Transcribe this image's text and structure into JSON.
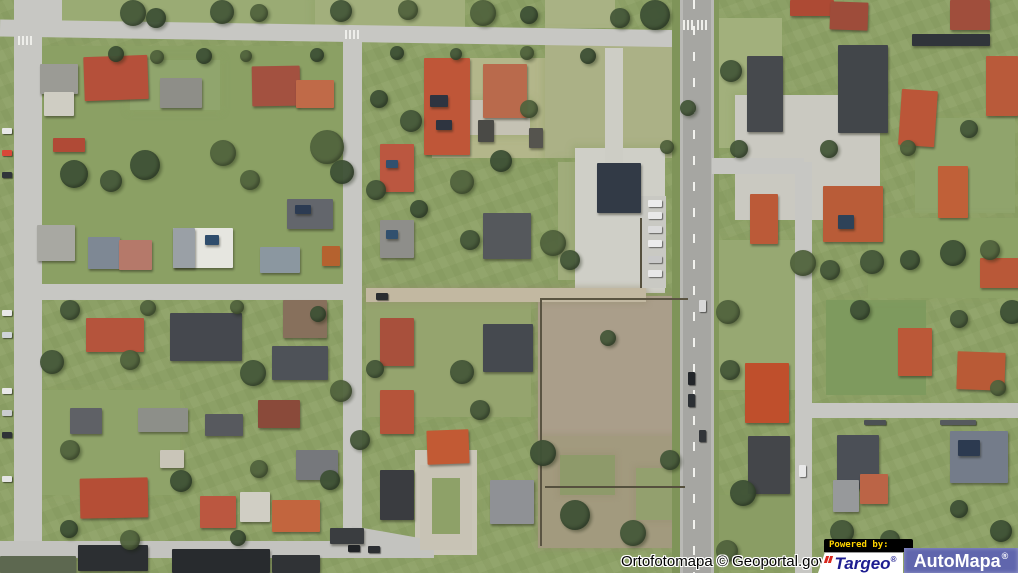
{
  "attribution": {
    "text": "Ortofotomapa © Geoportal.gov.pl"
  },
  "logos": {
    "powered_by": "Powered by:",
    "targeo": {
      "name": "Targeo",
      "registered": "®"
    },
    "automapa": {
      "name": "AutoMapa",
      "registered": "®"
    }
  },
  "colors": {
    "grass_base": "#8ca066",
    "road_gray": "#c7c7c3",
    "highway_asphalt": "#a6a6a2",
    "dirt_lot": "#aa9e8a",
    "roof_red": "#b5503a",
    "roof_dark": "#45484e",
    "targeo_navy": "#1d1d90",
    "targeo_red": "#d8251c",
    "automapa_blue": "#6066ad",
    "powered_yellow": "#ffd400",
    "attribution_text": "#000000",
    "attribution_halo": "#ffffff"
  },
  "map": {
    "fields": [
      [
        55,
        0,
        260,
        26,
        "#9aab74"
      ],
      [
        315,
        0,
        150,
        28,
        "#a2af7c"
      ],
      [
        545,
        0,
        70,
        28,
        "#a9b284"
      ],
      [
        432,
        58,
        118,
        100,
        "#b3b68a"
      ],
      [
        545,
        34,
        138,
        124,
        "#abb186"
      ],
      [
        558,
        162,
        96,
        118,
        "#a0ac7b"
      ],
      [
        366,
        302,
        165,
        115,
        "#95a46e"
      ],
      [
        28,
        46,
        330,
        238,
        "#8ba064"
      ],
      [
        30,
        390,
        150,
        105,
        "#8fa369"
      ],
      [
        712,
        18,
        70,
        130,
        "#a2b07c"
      ],
      [
        712,
        240,
        96,
        150,
        "#97a872"
      ],
      [
        915,
        118,
        100,
        95,
        "#90a46c"
      ],
      [
        826,
        300,
        100,
        95,
        "#7e9a5e"
      ],
      [
        712,
        495,
        100,
        75,
        "#8a9d64"
      ],
      [
        868,
        218,
        150,
        80,
        "#8da266"
      ],
      [
        575,
        148,
        90,
        145,
        "#cfcfc7"
      ],
      [
        735,
        95,
        145,
        125,
        "#cac9c1"
      ],
      [
        415,
        450,
        62,
        105,
        "#cac6b8"
      ],
      [
        455,
        100,
        75,
        35,
        "#c5c2b4"
      ],
      [
        130,
        60,
        90,
        50,
        "#90a56d"
      ]
    ],
    "lots": [
      [
        538,
        296,
        150,
        140,
        "#aa9e8a"
      ],
      [
        538,
        436,
        150,
        112,
        "#a29a7e"
      ],
      [
        560,
        455,
        55,
        40,
        "#8e9a6a"
      ],
      [
        636,
        468,
        48,
        52,
        "#93a06e"
      ],
      [
        366,
        288,
        280,
        14,
        "#c2b8a1"
      ]
    ],
    "roads": [
      [
        0,
        25,
        702,
        17,
        "#c7c7c3",
        0.9
      ],
      [
        40,
        0,
        22,
        28,
        "#c7c7c3"
      ],
      [
        14,
        0,
        28,
        573,
        "#c7c7c3"
      ],
      [
        343,
        38,
        19,
        507,
        "#c7c7c3"
      ],
      [
        28,
        284,
        320,
        16,
        "#c7c7c3"
      ],
      [
        0,
        541,
        434,
        17,
        "#c3c3bf"
      ],
      [
        350,
        532,
        70,
        16,
        "#c3c3bf",
        10
      ],
      [
        672,
        0,
        8,
        573,
        "#7f9459"
      ],
      [
        714,
        0,
        5,
        573,
        "#83985c"
      ],
      [
        680,
        0,
        34,
        573,
        "#a6a6a2"
      ],
      [
        680,
        0,
        3,
        573,
        "#b9b9b5"
      ],
      [
        711,
        0,
        3,
        573,
        "#b9b9b5"
      ],
      [
        712,
        158,
        92,
        16,
        "#c7c7c3"
      ],
      [
        795,
        162,
        17,
        411,
        "#c7c7c3"
      ],
      [
        803,
        403,
        215,
        15,
        "#c7c7c3"
      ],
      [
        640,
        196,
        26,
        92,
        "#c9c9c3"
      ],
      [
        605,
        48,
        18,
        118,
        "#cdcdc5"
      ],
      [
        420,
        465,
        52,
        85,
        "#c8c3b5"
      ],
      [
        432,
        478,
        28,
        56,
        "#8ea168"
      ]
    ],
    "lines": [
      [
        693,
        0,
        2,
        573,
        "dash"
      ],
      [
        540,
        298,
        148,
        2,
        "#5a5442"
      ],
      [
        540,
        298,
        2,
        248,
        "#5a5442"
      ],
      [
        545,
        486,
        140,
        2,
        "#55503e"
      ],
      [
        640,
        218,
        2,
        70,
        "#55503e"
      ],
      [
        18,
        36,
        2,
        9,
        "#eeeeea"
      ],
      [
        22,
        36,
        2,
        9,
        "#eeeeea"
      ],
      [
        26,
        36,
        2,
        9,
        "#eeeeea"
      ],
      [
        30,
        36,
        2,
        9,
        "#eeeeea"
      ],
      [
        345,
        30,
        2,
        9,
        "#eeeeea"
      ],
      [
        349,
        30,
        2,
        9,
        "#eeeeea"
      ],
      [
        353,
        30,
        2,
        9,
        "#eeeeea"
      ],
      [
        357,
        30,
        2,
        9,
        "#eeeeea"
      ],
      [
        683,
        20,
        2,
        10,
        "#eeeeea"
      ],
      [
        687,
        20,
        2,
        10,
        "#eeeeea"
      ],
      [
        691,
        20,
        2,
        10,
        "#eeeeea"
      ],
      [
        697,
        20,
        2,
        10,
        "#eeeeea"
      ],
      [
        701,
        20,
        2,
        10,
        "#eeeeea"
      ],
      [
        705,
        20,
        2,
        10,
        "#eeeeea"
      ]
    ],
    "houses": [
      [
        40,
        64,
        38,
        30,
        "#9b9b95"
      ],
      [
        44,
        92,
        30,
        24,
        "#cfcdc3"
      ],
      [
        84,
        56,
        64,
        44,
        "#b5503a",
        -2
      ],
      [
        160,
        78,
        42,
        30,
        "#8e8e88"
      ],
      [
        252,
        66,
        48,
        40,
        "#a35140",
        -1
      ],
      [
        296,
        80,
        38,
        28,
        "#c06a48"
      ],
      [
        53,
        138,
        32,
        14,
        "#b04a36"
      ],
      [
        424,
        58,
        46,
        97,
        "#bf5638"
      ],
      [
        430,
        95,
        18,
        12,
        "#2e3440"
      ],
      [
        436,
        120,
        16,
        10,
        "#2e3440"
      ],
      [
        483,
        64,
        44,
        54,
        "#b96a4c"
      ],
      [
        380,
        144,
        34,
        48,
        "#bb5740"
      ],
      [
        386,
        160,
        12,
        8,
        "#31506e"
      ],
      [
        478,
        120,
        16,
        22,
        "#4a4a46"
      ],
      [
        529,
        128,
        14,
        20,
        "#55544e"
      ],
      [
        597,
        163,
        44,
        50,
        "#323a46"
      ],
      [
        37,
        225,
        38,
        36,
        "#a8a8a2"
      ],
      [
        88,
        237,
        32,
        32,
        "#7e8894"
      ],
      [
        119,
        240,
        33,
        30,
        "#b5796a"
      ],
      [
        173,
        228,
        60,
        40,
        "#e6e6e0"
      ],
      [
        173,
        228,
        22,
        40,
        "#9aa0a6"
      ],
      [
        205,
        235,
        14,
        10,
        "#2f4d6c"
      ],
      [
        260,
        247,
        40,
        26,
        "#8b97a0"
      ],
      [
        287,
        199,
        46,
        30,
        "#63666c"
      ],
      [
        295,
        205,
        16,
        9,
        "#2c3b52"
      ],
      [
        322,
        246,
        18,
        20,
        "#b5622f"
      ],
      [
        380,
        220,
        34,
        38,
        "#8e8e8a"
      ],
      [
        386,
        230,
        12,
        9,
        "#31506e"
      ],
      [
        483,
        213,
        48,
        46,
        "#55585c"
      ],
      [
        86,
        318,
        58,
        34,
        "#b5543c"
      ],
      [
        170,
        313,
        72,
        48,
        "#45484e"
      ],
      [
        283,
        300,
        44,
        38,
        "#87705c"
      ],
      [
        272,
        346,
        56,
        34,
        "#4e5258"
      ],
      [
        380,
        318,
        34,
        48,
        "#a8503c"
      ],
      [
        483,
        324,
        50,
        48,
        "#45494f"
      ],
      [
        380,
        390,
        34,
        44,
        "#b5543a"
      ],
      [
        427,
        430,
        42,
        34,
        "#c25a34",
        -2
      ],
      [
        380,
        470,
        34,
        50,
        "#3a3c40"
      ],
      [
        490,
        480,
        44,
        44,
        "#8f9195"
      ],
      [
        138,
        408,
        50,
        24,
        "#8d8f89"
      ],
      [
        70,
        408,
        32,
        26,
        "#5f6166"
      ],
      [
        205,
        414,
        38,
        22,
        "#57595e"
      ],
      [
        258,
        400,
        42,
        28,
        "#8a4a3a"
      ],
      [
        296,
        450,
        42,
        30,
        "#76787c"
      ],
      [
        80,
        478,
        68,
        40,
        "#b54e36",
        -1
      ],
      [
        200,
        496,
        36,
        32,
        "#bb5740"
      ],
      [
        240,
        492,
        30,
        30,
        "#d0cec4"
      ],
      [
        272,
        500,
        48,
        32,
        "#c2653e"
      ],
      [
        160,
        450,
        24,
        18,
        "#c9c5b8"
      ],
      [
        78,
        545,
        70,
        26,
        "#2c2f32"
      ],
      [
        172,
        549,
        98,
        24,
        "#282b2e"
      ],
      [
        272,
        555,
        48,
        18,
        "#303336"
      ],
      [
        330,
        528,
        34,
        16,
        "#3a3d40"
      ],
      [
        0,
        556,
        76,
        17,
        "#5d6850"
      ],
      [
        790,
        0,
        44,
        16,
        "#ad4a34"
      ],
      [
        830,
        2,
        38,
        28,
        "#9e4c3a",
        2
      ],
      [
        950,
        0,
        40,
        30,
        "#a04e3c"
      ],
      [
        747,
        56,
        36,
        76,
        "#46494d"
      ],
      [
        838,
        45,
        50,
        88,
        "#42464a"
      ],
      [
        900,
        90,
        36,
        56,
        "#bb5638",
        4
      ],
      [
        986,
        56,
        32,
        60,
        "#b95a3a"
      ],
      [
        912,
        34,
        78,
        12,
        "#30343a"
      ],
      [
        750,
        194,
        28,
        50,
        "#bb5a38"
      ],
      [
        823,
        186,
        60,
        56,
        "#b95c38"
      ],
      [
        838,
        215,
        16,
        14,
        "#2e4258"
      ],
      [
        938,
        166,
        30,
        52,
        "#c06038"
      ],
      [
        980,
        258,
        40,
        30,
        "#b95838"
      ],
      [
        898,
        328,
        34,
        48,
        "#bb5838"
      ],
      [
        957,
        352,
        48,
        38,
        "#b95a36",
        2
      ],
      [
        745,
        363,
        44,
        60,
        "#bf4f2c"
      ],
      [
        748,
        436,
        42,
        58,
        "#44464a"
      ],
      [
        837,
        435,
        42,
        54,
        "#4b4f56"
      ],
      [
        950,
        431,
        58,
        52,
        "#747c8a"
      ],
      [
        958,
        440,
        22,
        16,
        "#2c3a50"
      ],
      [
        833,
        480,
        26,
        32,
        "#97999b"
      ],
      [
        860,
        474,
        28,
        30,
        "#bb6446"
      ]
    ],
    "trees": [
      [
        120,
        0,
        26
      ],
      [
        146,
        8,
        20
      ],
      [
        210,
        0,
        24
      ],
      [
        250,
        4,
        18
      ],
      [
        330,
        0,
        22
      ],
      [
        398,
        0,
        20
      ],
      [
        470,
        0,
        26
      ],
      [
        520,
        6,
        18
      ],
      [
        640,
        0,
        30
      ],
      [
        610,
        8,
        20
      ],
      [
        108,
        46,
        16
      ],
      [
        150,
        50,
        14
      ],
      [
        196,
        48,
        16
      ],
      [
        240,
        50,
        12
      ],
      [
        310,
        48,
        14
      ],
      [
        390,
        46,
        14
      ],
      [
        450,
        48,
        12
      ],
      [
        520,
        46,
        14
      ],
      [
        580,
        48,
        16
      ],
      [
        60,
        160,
        28
      ],
      [
        100,
        170,
        22
      ],
      [
        130,
        150,
        30
      ],
      [
        210,
        140,
        26
      ],
      [
        240,
        170,
        20
      ],
      [
        310,
        130,
        34
      ],
      [
        330,
        160,
        24
      ],
      [
        370,
        90,
        18
      ],
      [
        400,
        110,
        22
      ],
      [
        366,
        180,
        20
      ],
      [
        410,
        200,
        18
      ],
      [
        450,
        170,
        24
      ],
      [
        460,
        230,
        20
      ],
      [
        540,
        230,
        26
      ],
      [
        560,
        250,
        20
      ],
      [
        490,
        150,
        22
      ],
      [
        520,
        100,
        18
      ],
      [
        60,
        300,
        20
      ],
      [
        140,
        300,
        16
      ],
      [
        230,
        300,
        14
      ],
      [
        310,
        306,
        16
      ],
      [
        40,
        350,
        24
      ],
      [
        60,
        440,
        20
      ],
      [
        120,
        350,
        20
      ],
      [
        240,
        360,
        26
      ],
      [
        330,
        380,
        22
      ],
      [
        350,
        430,
        20
      ],
      [
        366,
        360,
        18
      ],
      [
        450,
        360,
        24
      ],
      [
        470,
        400,
        20
      ],
      [
        530,
        440,
        26
      ],
      [
        560,
        500,
        30
      ],
      [
        620,
        520,
        26
      ],
      [
        660,
        450,
        20
      ],
      [
        600,
        330,
        16
      ],
      [
        170,
        470,
        22
      ],
      [
        250,
        460,
        18
      ],
      [
        320,
        470,
        20
      ],
      [
        230,
        530,
        16
      ],
      [
        120,
        530,
        20
      ],
      [
        60,
        520,
        18
      ],
      [
        720,
        60,
        22
      ],
      [
        730,
        140,
        18
      ],
      [
        716,
        300,
        24
      ],
      [
        720,
        360,
        20
      ],
      [
        730,
        480,
        26
      ],
      [
        716,
        540,
        22
      ],
      [
        790,
        250,
        26
      ],
      [
        820,
        260,
        20
      ],
      [
        860,
        250,
        24
      ],
      [
        900,
        250,
        20
      ],
      [
        940,
        240,
        26
      ],
      [
        980,
        240,
        20
      ],
      [
        1000,
        300,
        24
      ],
      [
        820,
        140,
        18
      ],
      [
        900,
        140,
        16
      ],
      [
        960,
        120,
        18
      ],
      [
        850,
        300,
        20
      ],
      [
        950,
        310,
        18
      ],
      [
        990,
        380,
        16
      ],
      [
        830,
        520,
        24
      ],
      [
        880,
        530,
        20
      ],
      [
        950,
        500,
        18
      ],
      [
        990,
        520,
        22
      ],
      [
        680,
        100,
        16
      ],
      [
        660,
        140,
        14
      ]
    ],
    "cars": [
      [
        2,
        128,
        10,
        6,
        "#e8e8e8"
      ],
      [
        2,
        150,
        10,
        6,
        "#d84838"
      ],
      [
        2,
        172,
        10,
        6,
        "#30343a"
      ],
      [
        2,
        310,
        10,
        6,
        "#e8e8e8"
      ],
      [
        2,
        332,
        10,
        6,
        "#cfd4d8"
      ],
      [
        2,
        388,
        10,
        6,
        "#e8e8e8"
      ],
      [
        2,
        410,
        10,
        6,
        "#caccce"
      ],
      [
        2,
        432,
        10,
        6,
        "#2e3236"
      ],
      [
        2,
        476,
        10,
        6,
        "#e4e4e4"
      ],
      [
        648,
        200,
        14,
        7,
        "#ececec"
      ],
      [
        648,
        212,
        14,
        7,
        "#e8e8e8"
      ],
      [
        648,
        226,
        14,
        7,
        "#dadada"
      ],
      [
        648,
        240,
        14,
        7,
        "#ececec"
      ],
      [
        648,
        256,
        14,
        7,
        "#c8c8c8"
      ],
      [
        648,
        270,
        14,
        7,
        "#e8e8e8"
      ],
      [
        688,
        372,
        7,
        13,
        "#23262a"
      ],
      [
        688,
        394,
        7,
        13,
        "#2c3034"
      ],
      [
        699,
        300,
        7,
        12,
        "#d8d8d8"
      ],
      [
        699,
        430,
        7,
        12,
        "#33363a"
      ],
      [
        376,
        293,
        12,
        7,
        "#2a2d30"
      ],
      [
        864,
        420,
        22,
        5,
        "#4c5054"
      ],
      [
        940,
        420,
        36,
        5,
        "#565a5e"
      ],
      [
        799,
        465,
        7,
        12,
        "#e8e8e8"
      ],
      [
        348,
        545,
        12,
        7,
        "#202326"
      ],
      [
        368,
        546,
        12,
        7,
        "#2c2f33"
      ]
    ]
  }
}
